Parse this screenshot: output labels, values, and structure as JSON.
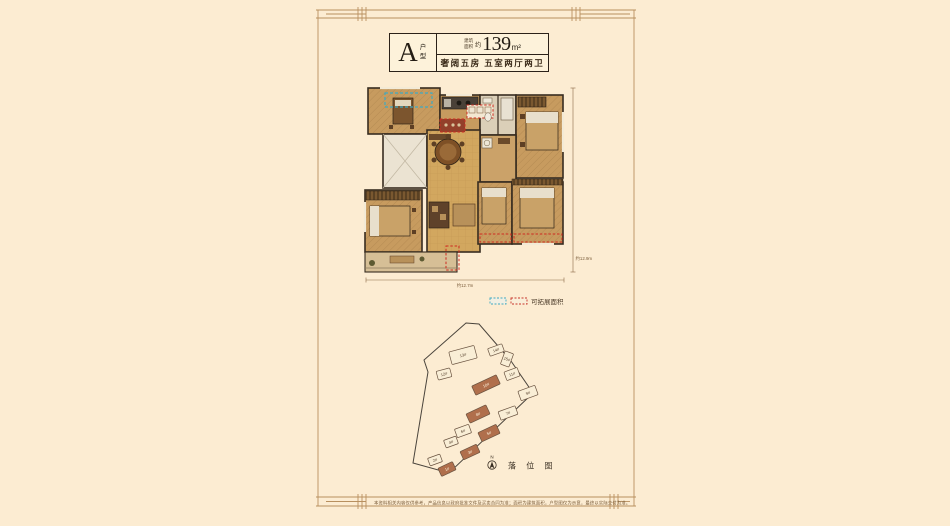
{
  "window": {
    "background": "#fcecd2"
  },
  "unit_card": {
    "type_letter": "A",
    "type_label": "户型",
    "area_label": "建筑面积",
    "area_prefix": "约",
    "area_value": "139",
    "area_unit": "m²",
    "tagline": "奢阔五房  五室两厅两卫"
  },
  "floor_plan": {
    "dim_width": "约12.7m",
    "dim_height": "约12.9m"
  },
  "legend": {
    "expand_teal_color": "#3fa9c2",
    "expand_red_color": "#c8352a",
    "label": "可拓展面积"
  },
  "site_plan": {
    "north_label": "N",
    "title": "落 位 图",
    "highlight_color": "#b06f4c",
    "outline_fill": "#f9eed6",
    "buildings": [
      {
        "label": "1#",
        "x": 49,
        "y": 151,
        "w": 16,
        "h": 9,
        "rot": -25,
        "filled": true
      },
      {
        "label": "2#",
        "x": 37,
        "y": 142,
        "w": 13,
        "h": 8,
        "rot": -20,
        "filled": false
      },
      {
        "label": "3#",
        "x": 72,
        "y": 134,
        "w": 18,
        "h": 9,
        "rot": -25,
        "filled": true
      },
      {
        "label": "4#",
        "x": 53,
        "y": 124,
        "w": 13,
        "h": 8,
        "rot": -20,
        "filled": false
      },
      {
        "label": "5#",
        "x": 91,
        "y": 115,
        "w": 20,
        "h": 10,
        "rot": -25,
        "filled": true
      },
      {
        "label": "6#",
        "x": 65,
        "y": 113,
        "w": 15,
        "h": 9,
        "rot": -20,
        "filled": false
      },
      {
        "label": "7#",
        "x": 110,
        "y": 95,
        "w": 18,
        "h": 9,
        "rot": -20,
        "filled": false
      },
      {
        "label": "8#",
        "x": 80,
        "y": 96,
        "w": 22,
        "h": 10,
        "rot": -25,
        "filled": true
      },
      {
        "label": "9#",
        "x": 130,
        "y": 75,
        "w": 18,
        "h": 10,
        "rot": -20,
        "filled": false
      },
      {
        "label": "10#",
        "x": 88,
        "y": 67,
        "w": 27,
        "h": 10,
        "rot": -25,
        "filled": true
      },
      {
        "label": "11#",
        "x": 114,
        "y": 56,
        "w": 14,
        "h": 9,
        "rot": -20,
        "filled": false
      },
      {
        "label": "12#",
        "x": 46,
        "y": 56,
        "w": 14,
        "h": 9,
        "rot": -15,
        "filled": false
      },
      {
        "label": "13#",
        "x": 65,
        "y": 37,
        "w": 26,
        "h": 13,
        "rot": -15,
        "filled": false
      },
      {
        "label": "14#",
        "x": 98,
        "y": 32,
        "w": 15,
        "h": 8,
        "rot": -20,
        "filled": false
      },
      {
        "label": "15#",
        "x": 109,
        "y": 41,
        "w": 9,
        "h": 14,
        "rot": 20,
        "filled": false
      }
    ]
  },
  "footer": {
    "disclaimer": "本资料相关内容仅供参考，产品信息以政府批准文件及买卖合同为准；面积为建筑面积，户型图仅为示意，最终以实际交付为准。"
  }
}
